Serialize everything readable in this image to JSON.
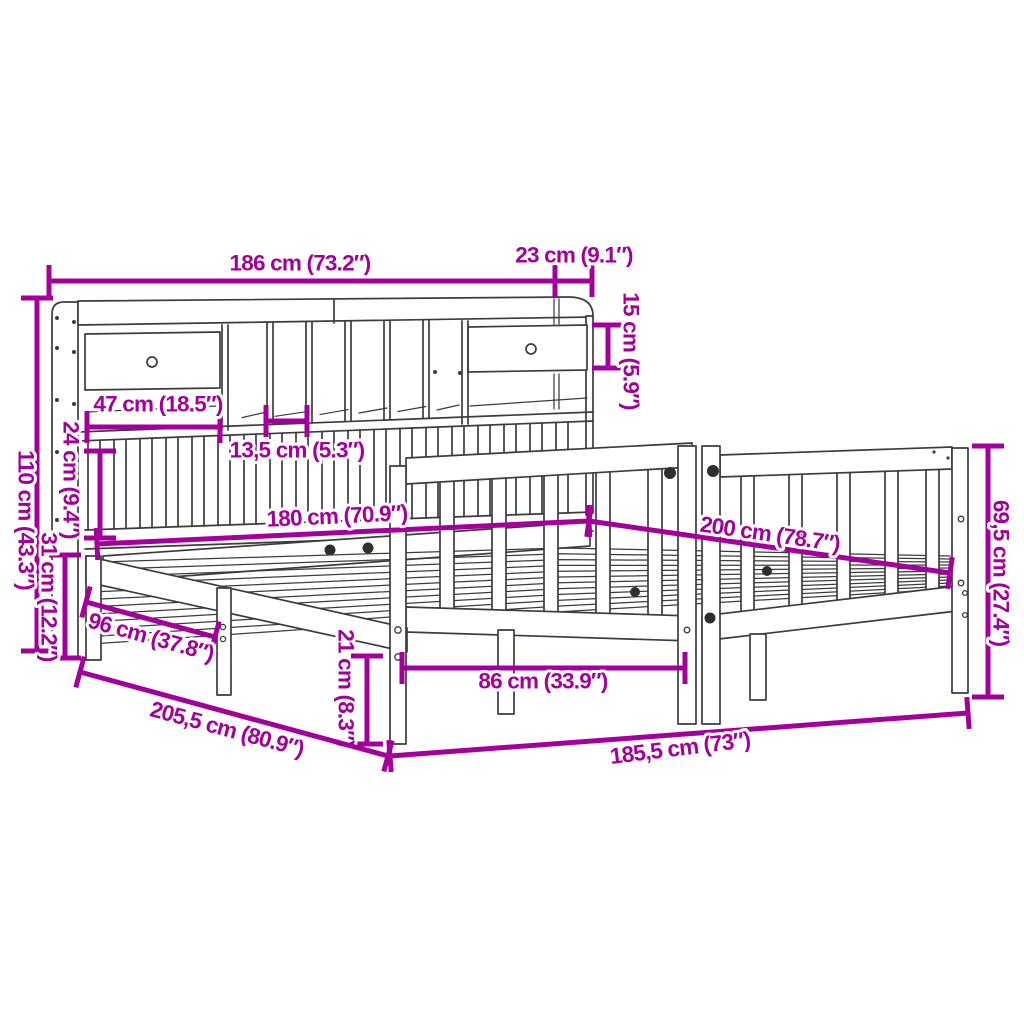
{
  "diagram": {
    "subject": "bookcase-bed-dimension-diagram",
    "colors": {
      "dimension_accent": "#A3009B",
      "line_art": "#3C3C3C",
      "background": "#FFFFFF"
    },
    "dimensions": [
      {
        "id": "bookcase-width",
        "label": "186 cm (73.2″)",
        "cm": "186",
        "inch": "73.2"
      },
      {
        "id": "bookcase-depth",
        "label": "23 cm (9.1″)",
        "cm": "23",
        "inch": "9.1"
      },
      {
        "id": "top-shelf-height",
        "label": "15 cm (5.9″)",
        "cm": "15",
        "inch": "5.9"
      },
      {
        "id": "headboard-height",
        "label": "110 cm (43.3″)",
        "cm": "110",
        "inch": "43.3"
      },
      {
        "id": "shelf-opening-height",
        "label": "24 cm (9.4″)",
        "cm": "24",
        "inch": "9.4"
      },
      {
        "id": "drawer-width",
        "label": "47 cm (18.5″)",
        "cm": "47",
        "inch": "18.5"
      },
      {
        "id": "slot-width",
        "label": "13,5 cm (5.3″)",
        "cm": "13,5",
        "inch": "5.3"
      },
      {
        "id": "base-height",
        "label": "31 cm (12.2″)",
        "cm": "31",
        "inch": "12.2"
      },
      {
        "id": "mattress-width",
        "label": "180 cm (70.9″)",
        "cm": "180",
        "inch": "70.9"
      },
      {
        "id": "mattress-length",
        "label": "200 cm (78.7″)",
        "cm": "200",
        "inch": "78.7"
      },
      {
        "id": "footboard-height",
        "label": "69,5 cm (27.4″)",
        "cm": "69,5",
        "inch": "27.4"
      },
      {
        "id": "frame-side-depth",
        "label": "96 cm (37.8″)",
        "cm": "96",
        "inch": "37.8"
      },
      {
        "id": "rail-height",
        "label": "21 cm (8.3″)",
        "cm": "21",
        "inch": "8.3"
      },
      {
        "id": "leg-spacing",
        "label": "86 cm (33.9″)",
        "cm": "86",
        "inch": "33.9"
      },
      {
        "id": "frame-depth",
        "label": "205,5 cm (80.9″)",
        "cm": "205,5",
        "inch": "80.9"
      },
      {
        "id": "frame-length",
        "label": "185,5 cm (73″)",
        "cm": "185,5",
        "inch": "73"
      }
    ]
  }
}
